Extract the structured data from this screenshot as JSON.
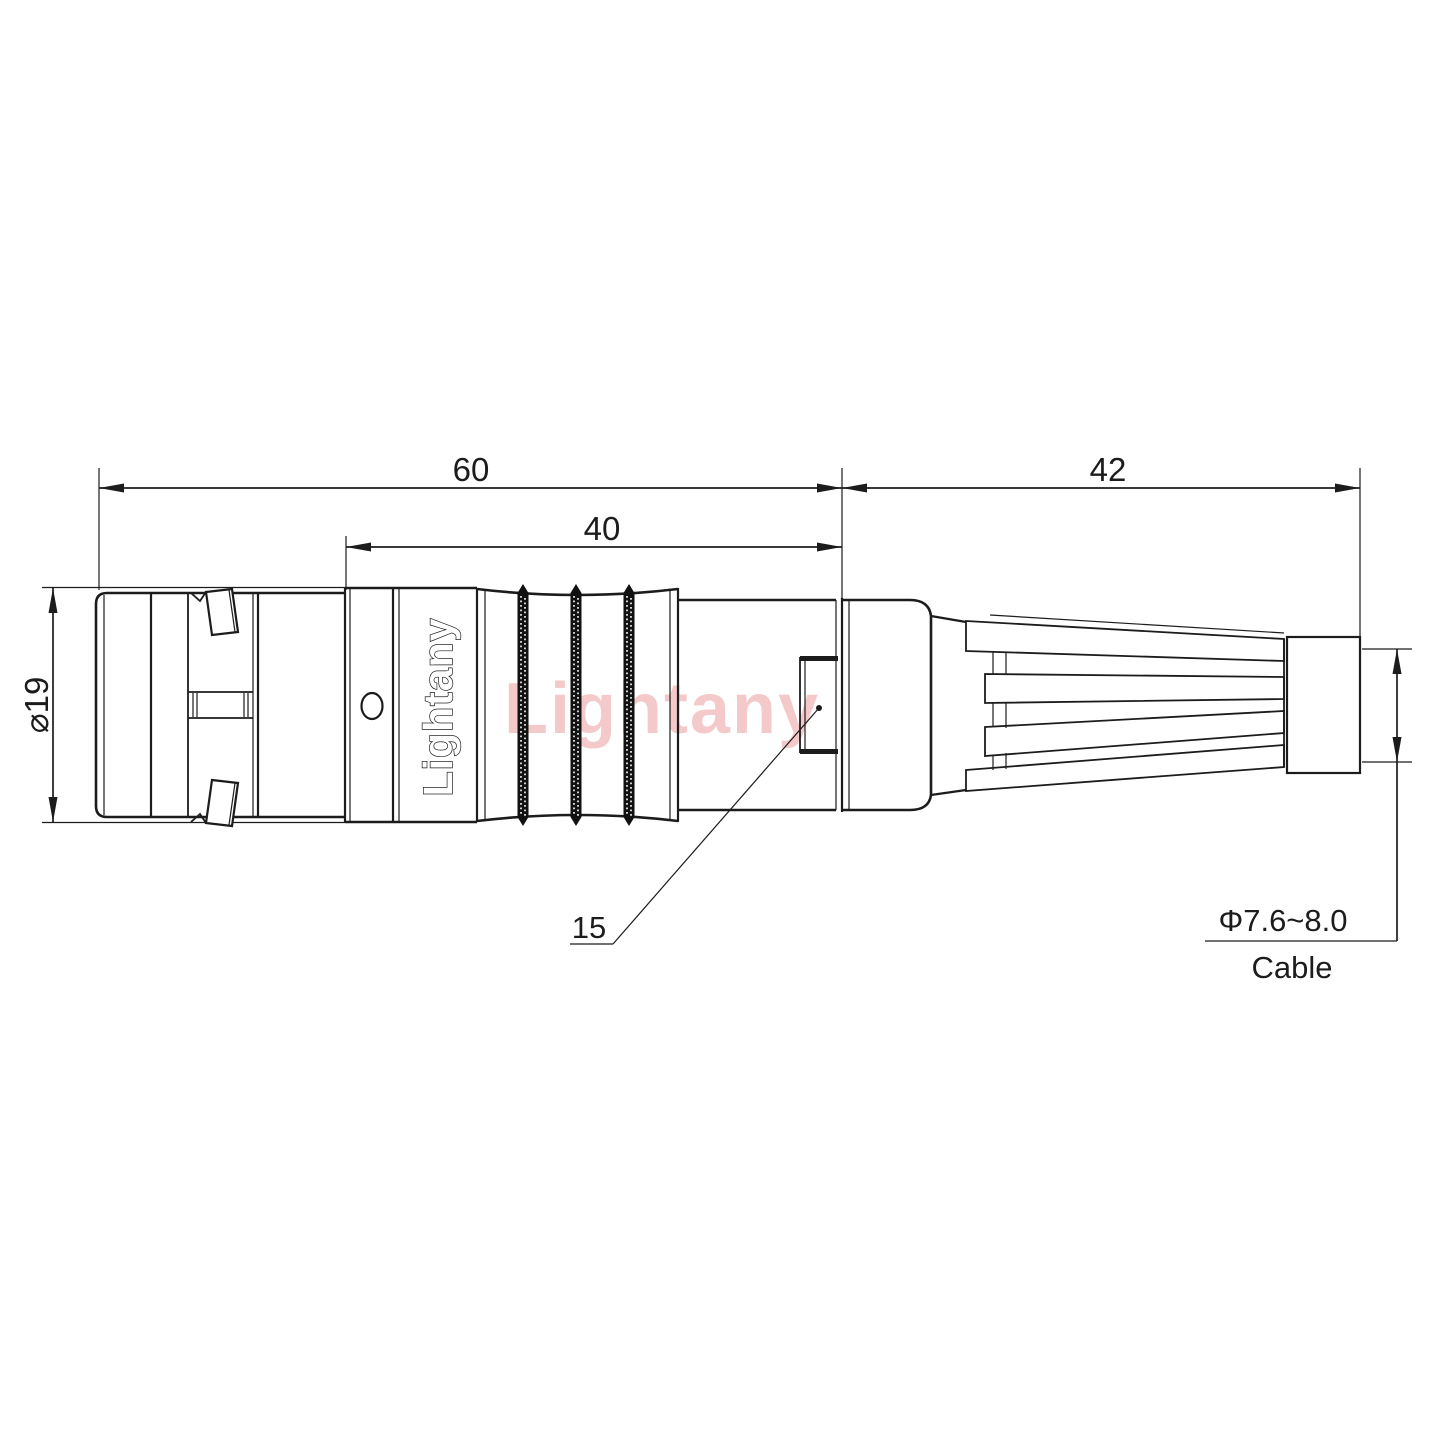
{
  "labels": {
    "len60": "60",
    "len40": "40",
    "len42": "42",
    "dia19": "⌀19",
    "detail15": "15",
    "cable_dia": "Φ7.6~8.0",
    "cable": "Cable"
  },
  "brand": {
    "engraving": "Lightany",
    "watermark": "Lightany"
  },
  "colors": {
    "line": "#1c1c1c",
    "watermark": "#ec9d9d"
  }
}
